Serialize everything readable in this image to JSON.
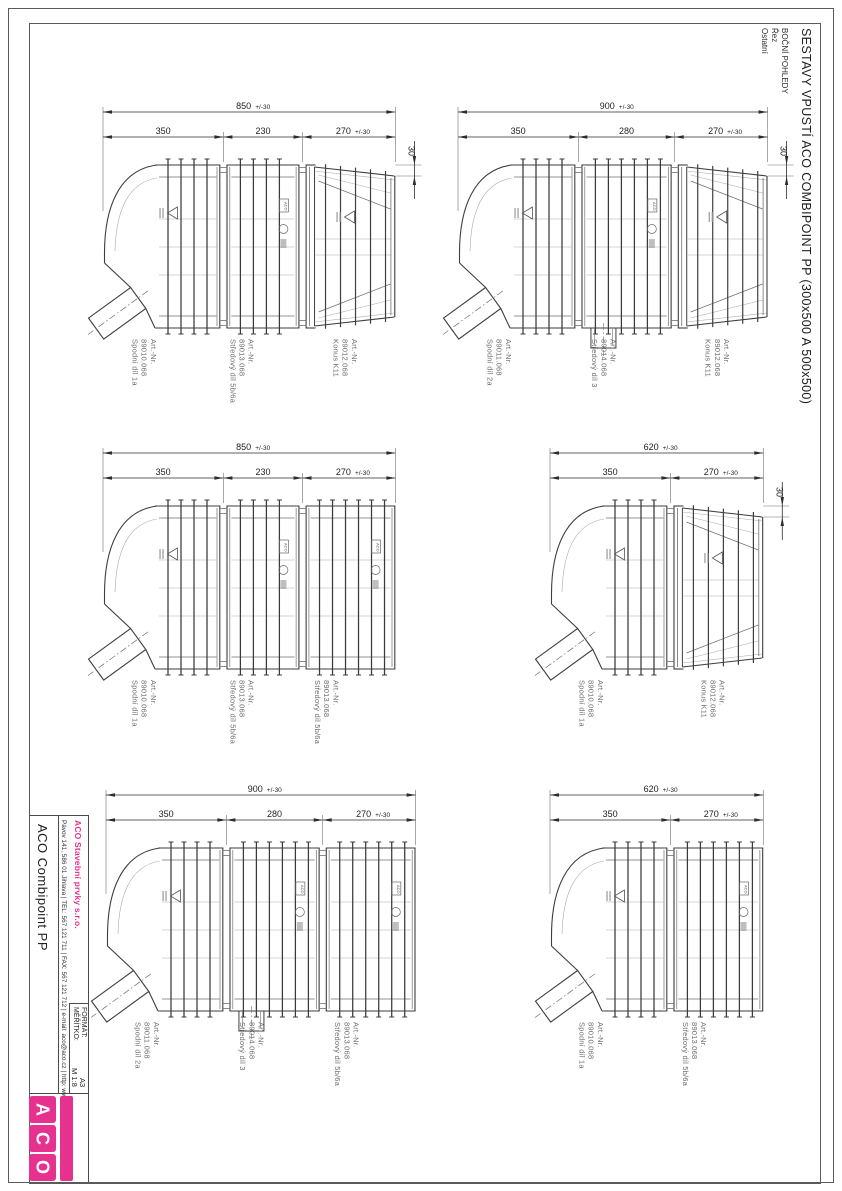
{
  "page": {
    "title": "SESTAVY VPUSTÍ ACO COMBIPOINT PP (300x500 A 500x500)",
    "view_labels": [
      "BOČNÍ POHLEDY",
      "Řez",
      "Ostatní"
    ]
  },
  "markings": {
    "aco": "ACO"
  },
  "title_block": {
    "product": "ACO Combipoint PP",
    "company": "ACO Stavební prvky s.r.o.",
    "address": "Pávov 141, 586 01 Jihlava | TEL: 567 121 711 | FAX: 567 121 712 | e-mail: aco@aco.cz | http: www.aco.cz",
    "format_label": "FORMÁT:",
    "format_value": "A3",
    "scale_label": "MĚŘÍTKO:",
    "scale_value": "M 1:8",
    "logo_letters": [
      "A",
      "C",
      "O"
    ],
    "brand_color": "#e6318f"
  },
  "assemblies": [
    {
      "total": {
        "value": "850",
        "tol": "+/-30",
        "mm": 850
      },
      "step": "30",
      "segments": [
        {
          "dim": {
            "value": "350",
            "mm": 350
          },
          "shape": "elbow",
          "part": {
            "art": "Art.-Nr.",
            "no": "89010.068",
            "name": "Spodní díl 1a"
          }
        },
        {
          "dim": {
            "value": "230",
            "mm": 230
          },
          "shape": "barrel",
          "part": {
            "art": "Art.-Nr.",
            "no": "89013.068",
            "name": "Středový díl 5b/6a"
          }
        },
        {
          "dim": {
            "value": "270",
            "tol": "+/-30",
            "mm": 270
          },
          "shape": "cone",
          "part": {
            "art": "Art.-Nr.",
            "no": "89012.068",
            "name": "Konus K11"
          }
        }
      ]
    },
    {
      "total": {
        "value": "900",
        "tol": "+/-30",
        "mm": 900
      },
      "step": "30",
      "segments": [
        {
          "dim": {
            "value": "350",
            "mm": 350
          },
          "shape": "elbow",
          "part": {
            "art": "Art.-Nr.",
            "no": "89011.068",
            "name": "Spodní díl 2a"
          }
        },
        {
          "dim": {
            "value": "280",
            "mm": 280
          },
          "shape": "barrel-outlet",
          "part": {
            "art": "Art.-Nr.",
            "no": "89014.068",
            "name": "Středový díl 3"
          }
        },
        {
          "dim": {
            "value": "270",
            "tol": "+/-30",
            "mm": 270
          },
          "shape": "cone",
          "part": {
            "art": "Art.-Nr.",
            "no": "89012.068",
            "name": "Konus K11"
          }
        }
      ]
    },
    {
      "total": {
        "value": "850",
        "tol": "+/-30",
        "mm": 850
      },
      "step": null,
      "segments": [
        {
          "dim": {
            "value": "350",
            "mm": 350
          },
          "shape": "elbow",
          "part": {
            "art": "Art.-Nr.",
            "no": "89010.068",
            "name": "Spodní díl 1a"
          }
        },
        {
          "dim": {
            "value": "230",
            "mm": 230
          },
          "shape": "barrel",
          "part": {
            "art": "Art.-Nr.",
            "no": "89013.068",
            "name": "Středový díl 5b/6a"
          }
        },
        {
          "dim": {
            "value": "270",
            "tol": "+/-30",
            "mm": 270
          },
          "shape": "barrel",
          "part": {
            "art": "Art.-Nr.",
            "no": "89013.068",
            "name": "Středový díl 5b/6a"
          }
        }
      ]
    },
    {
      "total": {
        "value": "620",
        "tol": "+/-30",
        "mm": 620
      },
      "step": "30",
      "segments": [
        {
          "dim": {
            "value": "350",
            "mm": 350
          },
          "shape": "elbow",
          "part": {
            "art": "Art.-Nr.",
            "no": "89010.068",
            "name": "Spodní díl 1a"
          }
        },
        {
          "dim": {
            "value": "270",
            "tol": "+/-30",
            "mm": 270
          },
          "shape": "cone",
          "part": {
            "art": "Art.-Nr.",
            "no": "89012.068",
            "name": "Konus K11"
          }
        }
      ]
    },
    {
      "total": {
        "value": "900",
        "tol": "+/-30",
        "mm": 900
      },
      "step": null,
      "segments": [
        {
          "dim": {
            "value": "350",
            "mm": 350
          },
          "shape": "elbow",
          "part": {
            "art": "Art.-Nr.",
            "no": "89011.068",
            "name": "Spodní díl 2a"
          }
        },
        {
          "dim": {
            "value": "280",
            "mm": 280
          },
          "shape": "barrel-outlet",
          "part": {
            "art": "Art.-Nr.",
            "no": "89014.068",
            "name": "Středový díl 3"
          }
        },
        {
          "dim": {
            "value": "270",
            "tol": "+/-30",
            "mm": 270
          },
          "shape": "barrel",
          "part": {
            "art": "Art.-Nr.",
            "no": "89013.068",
            "name": "Středový díl 5b/6a"
          }
        }
      ]
    },
    {
      "total": {
        "value": "620",
        "tol": "+/-30",
        "mm": 620
      },
      "step": null,
      "segments": [
        {
          "dim": {
            "value": "350",
            "mm": 350
          },
          "shape": "elbow",
          "part": {
            "art": "Art.-Nr.",
            "no": "89010.068",
            "name": "Spodní díl 1a"
          }
        },
        {
          "dim": {
            "value": "270",
            "tol": "+/-30",
            "mm": 270
          },
          "shape": "barrel",
          "part": {
            "art": "Art.-Nr.",
            "no": "89013.068",
            "name": "Středový díl 5b/6a"
          }
        }
      ]
    }
  ]
}
